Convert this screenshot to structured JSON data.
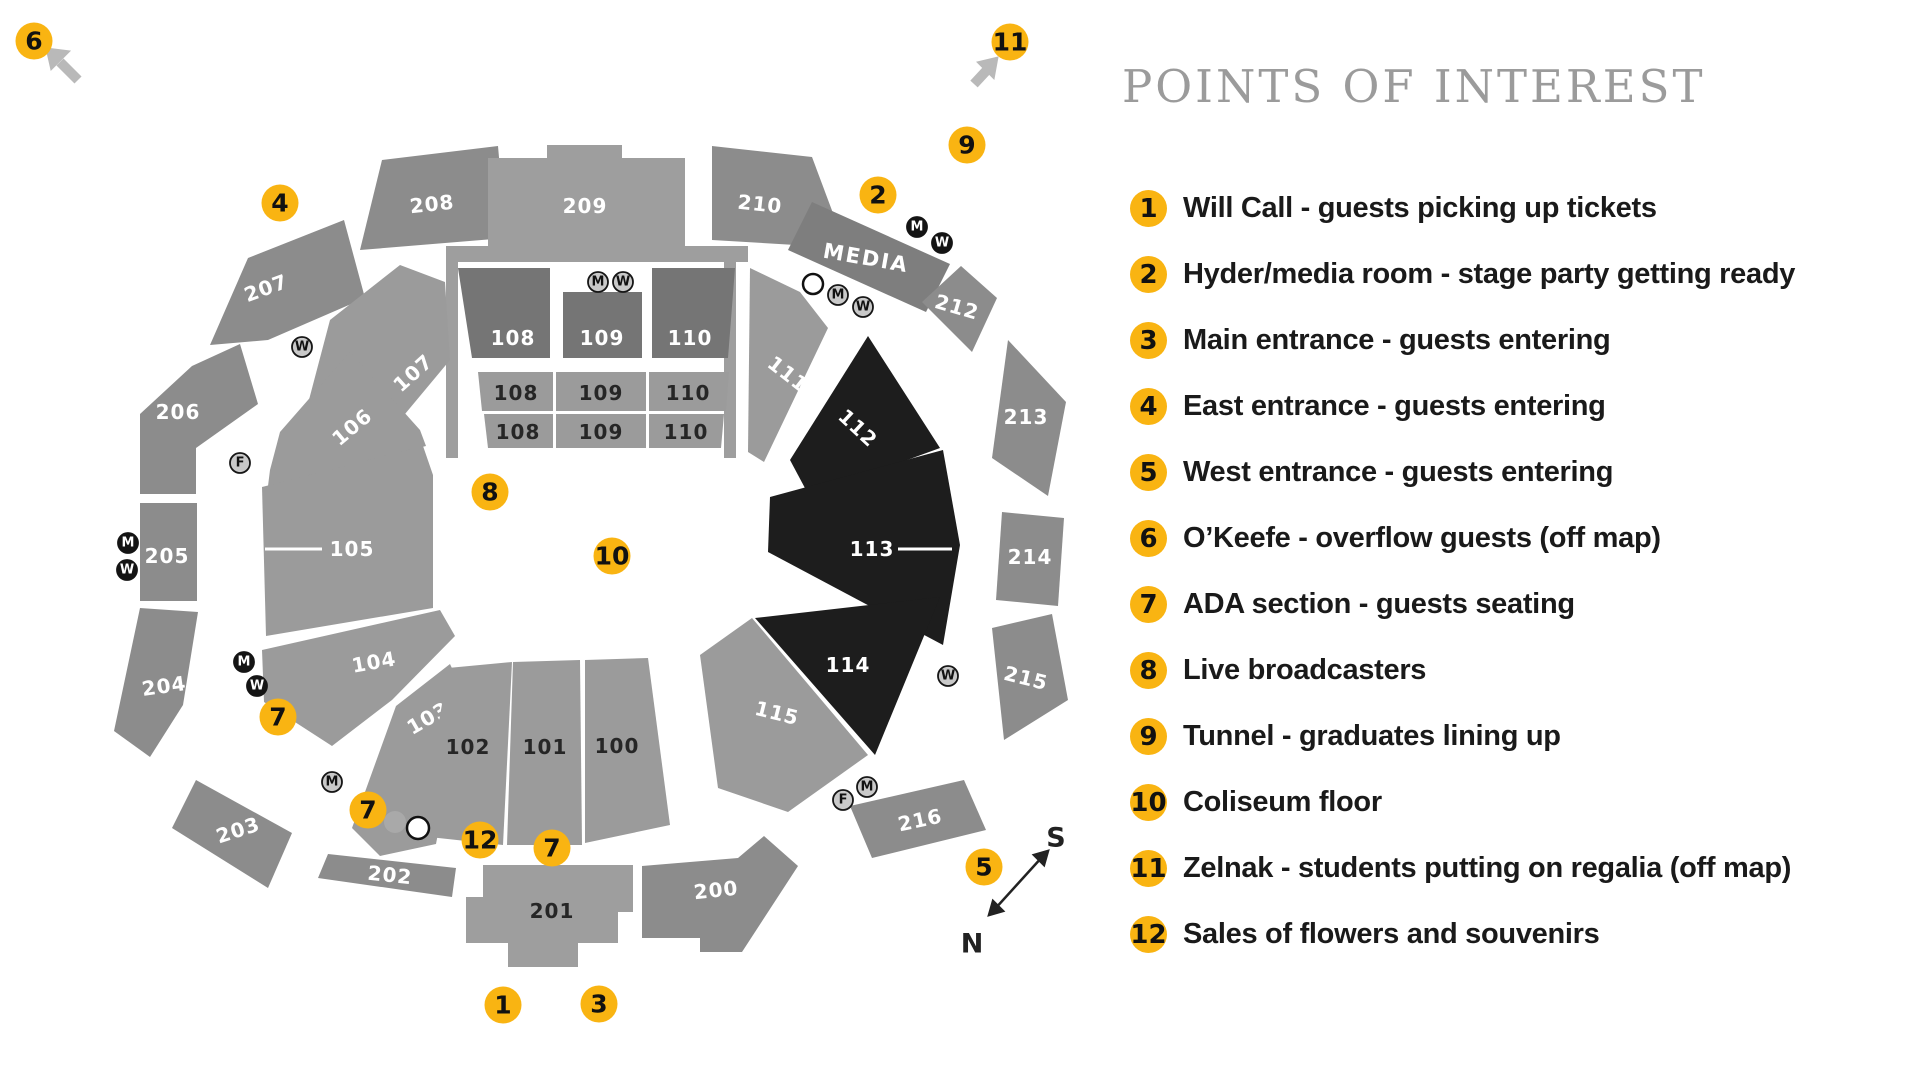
{
  "legend": {
    "title": "POINTS OF INTEREST",
    "items": [
      {
        "num": "1",
        "label": "Will Call - guests picking up tickets"
      },
      {
        "num": "2",
        "label": "Hyder/media room - stage party getting ready"
      },
      {
        "num": "3",
        "label": "Main entrance - guests entering"
      },
      {
        "num": "4",
        "label": "East entrance - guests entering"
      },
      {
        "num": "5",
        "label": "West entrance - guests entering"
      },
      {
        "num": "6",
        "label": "O’Keefe - overflow guests (off map)"
      },
      {
        "num": "7",
        "label": "ADA section - guests seating"
      },
      {
        "num": "8",
        "label": "Live broadcasters"
      },
      {
        "num": "9",
        "label": "Tunnel - graduates lining up"
      },
      {
        "num": "10",
        "label": "Coliseum floor"
      },
      {
        "num": "11",
        "label": "Zelnak - students putting on regalia (off map)"
      },
      {
        "num": "12",
        "label": "Sales of flowers and souvenirs"
      }
    ]
  },
  "map": {
    "sections": {
      "s100": "100",
      "s101": "101",
      "s102": "102",
      "s103": "103",
      "s104": "104",
      "s105": "105",
      "s106": "106",
      "s107": "107",
      "s108": "108",
      "s109": "109",
      "s110": "110",
      "s111": "111",
      "s112": "112",
      "s113": "113",
      "s114": "114",
      "s115": "115",
      "s200": "200",
      "s201": "201",
      "s202": "202",
      "s203": "203",
      "s204": "204",
      "s205": "205",
      "s206": "206",
      "s207": "207",
      "s208": "208",
      "s209": "209",
      "s210": "210",
      "s212": "212",
      "s213": "213",
      "s214": "214",
      "s215": "215",
      "s216": "216",
      "media": "MEDIA"
    },
    "markers": {
      "m1": "1",
      "m2": "2",
      "m3": "3",
      "m4": "4",
      "m5": "5",
      "m6": "6",
      "m7": "7",
      "m8": "8",
      "m9": "9",
      "m10": "10",
      "m11": "11",
      "m12": "12"
    },
    "icons": {
      "men": "M",
      "women": "W",
      "family": "F"
    },
    "compass": {
      "south": "S",
      "north": "N"
    },
    "colors": {
      "accent": "#F9B412",
      "ring_gray": "#8C8C8C",
      "bowl_gray": "#9B9B9B",
      "dark_section": "#1D1D1D",
      "upper_dark": "#757575",
      "media_gray": "#7E7E7E",
      "title_gray": "#9B9B9B",
      "legend_text": "#1A1A1A"
    }
  }
}
